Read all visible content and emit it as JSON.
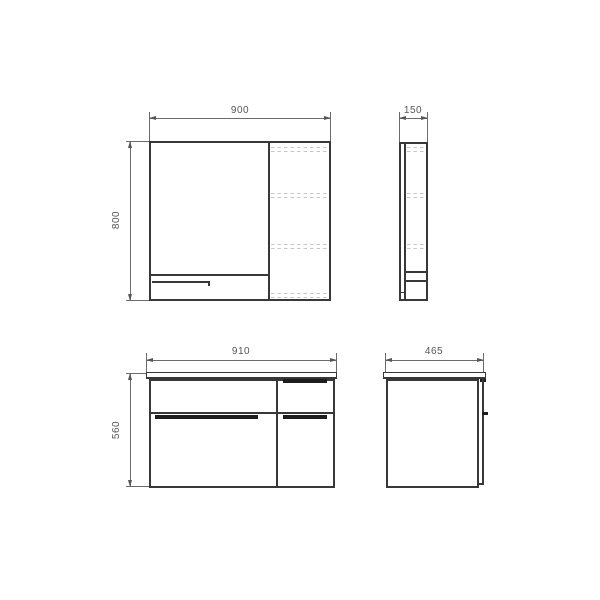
{
  "dimensions": {
    "mirror_front": {
      "width": "900",
      "height": "800"
    },
    "mirror_side": {
      "depth": "150"
    },
    "vanity_front": {
      "width": "910",
      "height": "560"
    },
    "vanity_side": {
      "depth": "465"
    }
  },
  "colors": {
    "outline": "#383838",
    "dimension_line": "#6b6b6b",
    "dimension_text": "#565656",
    "hidden_shelf_line": "#c7c7c7",
    "handle_groove": "#1d1d1d",
    "background": "#ffffff"
  }
}
